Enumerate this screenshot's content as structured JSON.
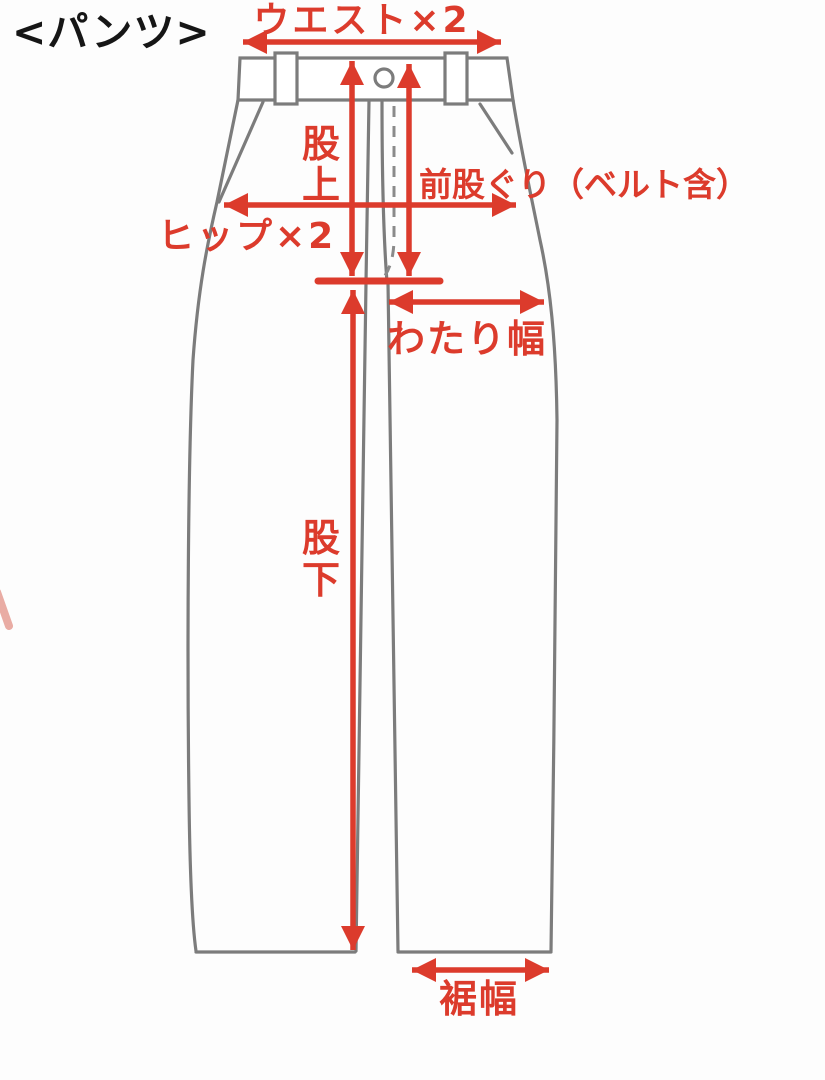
{
  "diagram": {
    "title": "<パンツ>",
    "subject": "pants-size-measurement-guide"
  },
  "measurements": {
    "waist": {
      "label": "ウエスト×2"
    },
    "rise": {
      "label": "股上",
      "chars": [
        "股",
        "上"
      ]
    },
    "front_rise": {
      "label": "前股ぐり（ベルト含）"
    },
    "hip": {
      "label": "ヒップ×2"
    },
    "thigh": {
      "label": "わたり幅"
    },
    "inseam": {
      "label": "股下",
      "chars": [
        "股",
        "下"
      ]
    },
    "hem": {
      "label": "裾幅"
    }
  },
  "colors": {
    "arrow_red": "#dc3b2c",
    "outline_gray": "#7c7c7c",
    "title_black": "#161616",
    "background": "#fdfdfd"
  }
}
